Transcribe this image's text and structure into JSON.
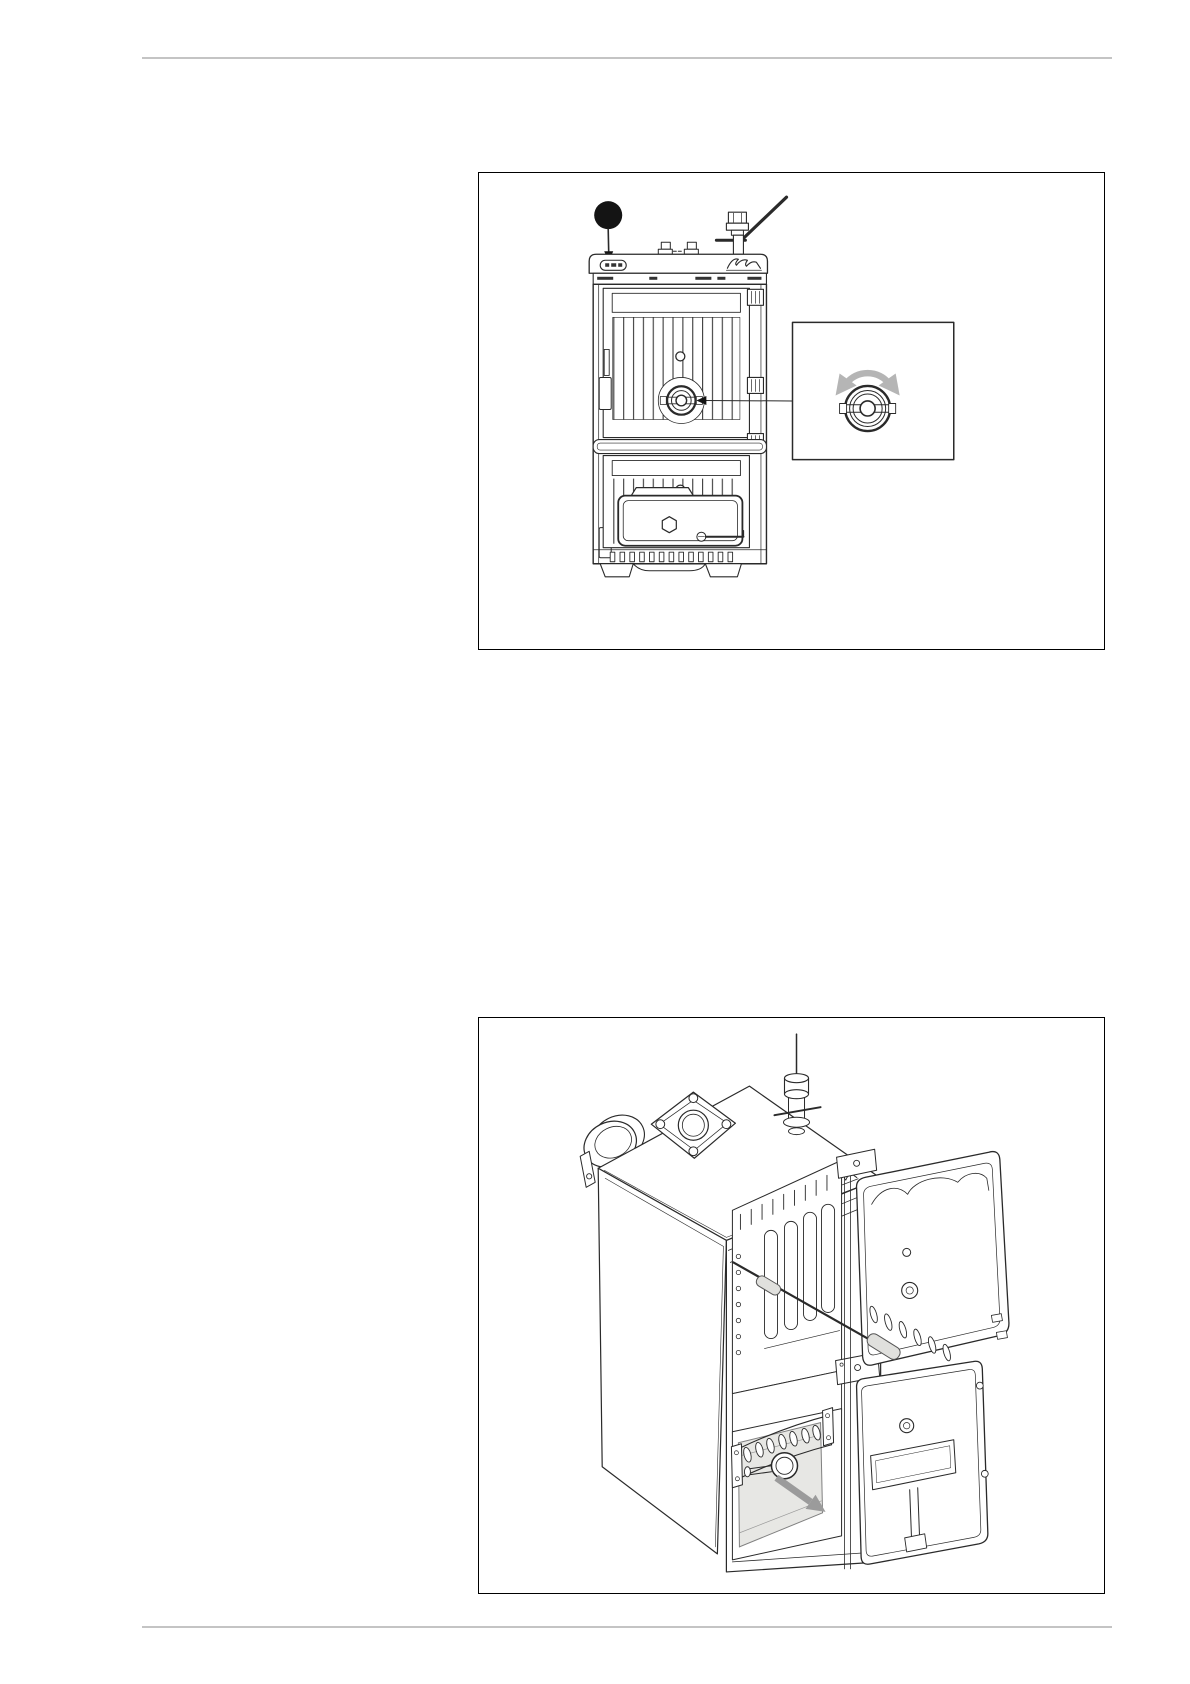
{
  "page": {
    "background_color": "#ffffff",
    "divider_color": "#c4c4c4",
    "frame_border_color": "#000000"
  },
  "colors": {
    "line_art": "#2a2a2a",
    "callout_fill": "#141414",
    "rotation_arrow_gray": "#b5b5b5",
    "direction_arrow_gray": "#9b9b9b",
    "tool_grip_fill": "#e0e0dd",
    "ash_pan_fill": "#e7e7e4"
  },
  "figures": [
    {
      "name": "boiler-front-view",
      "alt": "Line drawing: front view of a cast-iron solid-fuel boiler; a solid black callout balloon with an arrow points to the control panel; a leader line links the central regulator knob to a magnified inset showing the knob with a curved double-headed rotation arrow.",
      "icons": [
        {
          "name": "callout-balloon",
          "glyph": "filled-circle"
        },
        {
          "name": "callout-pointer-arrow",
          "glyph": "arrow-down"
        },
        {
          "name": "rotation-arrows-icon",
          "glyph": "curved-double-arrow"
        },
        {
          "name": "regulator-knob",
          "glyph": "concentric-circles-with-slot"
        },
        {
          "name": "safety-valve-lever",
          "glyph": "diagonal-lever"
        }
      ]
    },
    {
      "name": "boiler-open-doors-view",
      "alt": "Line drawing: isometric view of the boiler with upper and lower front doors swung open; a cleaning rod with grey grips is inserted between the heat-exchanger sections; a thick grey arrow shows the ash pan being pulled out toward the lower right.",
      "icons": [
        {
          "name": "cleaning-tool",
          "glyph": "rod-with-grips"
        },
        {
          "name": "removal-arrow-icon",
          "glyph": "thick-diagonal-arrow"
        },
        {
          "name": "ash-pan",
          "glyph": "grey-drawer"
        },
        {
          "name": "flue-collar",
          "glyph": "concentric-ellipses"
        }
      ]
    }
  ]
}
